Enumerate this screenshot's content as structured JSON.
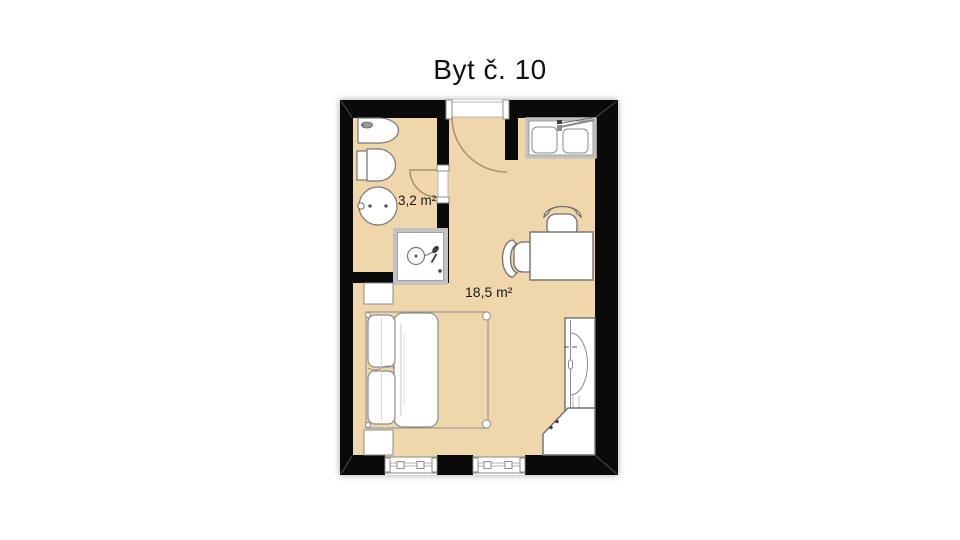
{
  "title": "Byt č. 10",
  "colors": {
    "background": "#ffffff",
    "floor": "#f0d6ab",
    "wall": "#0a0a0a",
    "door_arc": "#ad9068",
    "furniture_stroke": "#6f6f6f",
    "frame_gray": "#c2c2c2",
    "text": "#1a1a1a"
  },
  "rooms": [
    {
      "name": "bathroom",
      "area_label": "3,2 m²"
    },
    {
      "name": "living-room",
      "area_label": "18,5 m²"
    }
  ],
  "furniture": [
    "bidet",
    "toilet",
    "washbasin",
    "shower-enclosure",
    "entry-door",
    "bathroom-door",
    "built-in-wardrobe",
    "table",
    "chair",
    "chair",
    "wardrobe",
    "corner-wardrobe",
    "double-bed",
    "nightstand",
    "nightstand",
    "window",
    "window"
  ]
}
